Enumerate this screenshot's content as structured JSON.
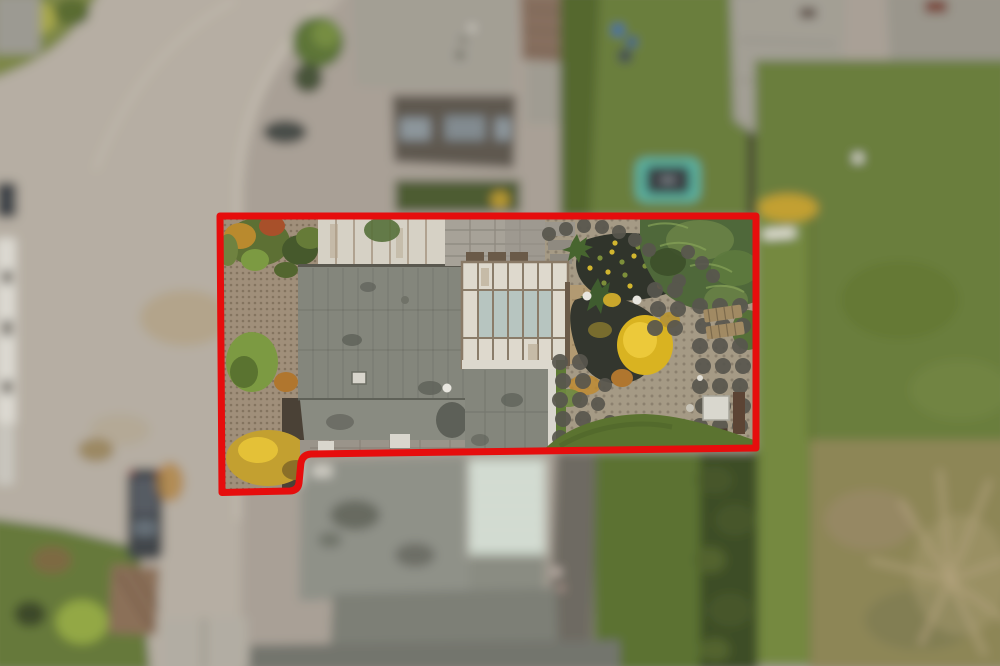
{
  "meta": {
    "image_type": "aerial-drone-photograph",
    "view": "top-down nadir view of suburban residential parcels, autumn",
    "focus": "center parcel sharp, surroundings motion/depth blurred",
    "annotation_kind": "property boundary outline"
  },
  "annotation": {
    "boundary_path": "M220,216 L756,216 L756,448 L311,454 Q302,454.6 300.8,464 L299,483 Q298,490.5 290,491 L222,492.5 Z",
    "color": "#e60d0d",
    "stroke_width": 7
  },
  "palette": {
    "pavement": "#a9a096",
    "road": "#b6aea3",
    "curb": "#cfc8bc",
    "road_leaves": "#b09a6f",
    "roof_main": "#84867c",
    "roof_seam": "#5a584f",
    "roof_panel": "#d6d1c5",
    "panel_seam": "#a3937f",
    "frame_white": "#ded9cd",
    "glass": "#b7c5c0",
    "mullion": "#8a7c69",
    "gravel": "#a08f7a",
    "garden_ground": "#a59a85",
    "paver": "#58564e",
    "slab": "#a7a298",
    "pond": "#30342b",
    "soil": "#4a4136",
    "hedge": "#4f683a",
    "hedge_hi": "#6d8549",
    "hedge_dark": "#3e4d27",
    "lawn": "#6a7e3c",
    "lawn_bright": "#74893f",
    "lawn_in": "#5b7330",
    "meadow": "#8d8657",
    "meadow_tree": "#b4a37d",
    "terrace": "#b29a72",
    "wood": "#a18a63",
    "wood_dark": "#6a5a48",
    "tramp_ring": "#5ab3a1",
    "tramp_mat": "#3a4045",
    "roof_neighbor": "#a39f94",
    "roof_brown": "#87705f",
    "wall_dark": "#5e5850",
    "conservatory": "#c9d4c9",
    "conservatory_line": "#ecefe7",
    "drive": "#6e6b62",
    "shed": "#8b6f58",
    "car_dark": "#42464b",
    "white_detail": "#ded9cf",
    "yellow_shrub": "#c3a030",
    "yellow_tree": "#d9b321",
    "yellow_tree_hi": "#ecc93a",
    "orange_shrub": "#b0762e",
    "bush_green": "#7c9a42",
    "bush_dark": "#46592c",
    "roof_front": "#8f9188",
    "roof_low": "#7d7f76",
    "stain": "#5e6058"
  },
  "garden": {
    "paver_clusters": [
      {
        "type": "points",
        "r": 7,
        "points": [
          [
            549,
            234
          ],
          [
            566,
            229
          ],
          [
            584,
            226
          ],
          [
            602,
            227
          ],
          [
            619,
            232
          ],
          [
            635,
            240
          ],
          [
            649,
            250
          ]
        ]
      },
      {
        "type": "points",
        "r": 7,
        "points": [
          [
            688,
            252
          ],
          [
            702,
            263
          ],
          [
            713,
            276
          ],
          [
            679,
            281
          ]
        ]
      },
      {
        "type": "grid",
        "x": 700,
        "y": 306,
        "dx": 20,
        "dy": 20,
        "cols": 3,
        "rows": 7,
        "r": 8
      },
      {
        "type": "grid",
        "x": 655,
        "y": 290,
        "dx": 20,
        "dy": 19,
        "cols": 2,
        "rows": 3,
        "r": 8
      },
      {
        "type": "grid",
        "x": 560,
        "y": 362,
        "dx": 20,
        "dy": 19,
        "cols": 2,
        "rows": 5,
        "r": 8
      },
      {
        "type": "points",
        "r": 7,
        "points": [
          [
            605,
            385
          ],
          [
            598,
            404
          ],
          [
            610,
            422
          ],
          [
            601,
            440
          ],
          [
            622,
            438
          ],
          [
            641,
            444
          ],
          [
            660,
            430
          ],
          [
            676,
            440
          ]
        ]
      }
    ],
    "lily_pads": [
      [
        600,
        258
      ],
      [
        612,
        252
      ],
      [
        622,
        262
      ],
      [
        634,
        256
      ],
      [
        645,
        266
      ],
      [
        608,
        272
      ],
      [
        625,
        275
      ],
      [
        590,
        268
      ],
      [
        638,
        247
      ],
      [
        615,
        243
      ],
      [
        604,
        283
      ],
      [
        630,
        286
      ]
    ],
    "lily_colors": [
      "#7d8f3a",
      "#d2b62f"
    ],
    "lamp_globes": [
      [
        587,
        296
      ],
      [
        637,
        300
      ],
      [
        447,
        388
      ]
    ],
    "lamp_color": "#e8e6df"
  },
  "scene": {
    "in_focus_parcel": [
      {
        "name": "gravel-driveway",
        "desc": "tan gravel forecourt, left side of parcel"
      },
      {
        "name": "shrub-border",
        "desc": "mixed green/orange autumn shrubs along top-left boundary"
      },
      {
        "name": "panel-roof",
        "desc": "weathered white vertical-plank roof section, top of house"
      },
      {
        "name": "main-roof",
        "desc": "large flat grey roof with plank seams, stains and vent"
      },
      {
        "name": "glass-atrium-roof",
        "desc": "white-framed skylight roof with pale green glass panes"
      },
      {
        "name": "terrace",
        "desc": "tan paved terrace right of atrium"
      },
      {
        "name": "pond",
        "desc": "dark garden pond with lily pads and globe lamps"
      },
      {
        "name": "paver-circles",
        "desc": "round dark stepping pavers across rear garden"
      },
      {
        "name": "conifer-hedge",
        "desc": "large green conifer mass in top-right of garden"
      },
      {
        "name": "yellow-maple",
        "desc": "bright yellow autumn shrub in garden center"
      },
      {
        "name": "sun-loungers",
        "desc": "two wooden loungers on circle pavers"
      },
      {
        "name": "garden-table",
        "desc": "white table and dark wood bench, bottom-right"
      },
      {
        "name": "inner-lawn",
        "desc": "green lawn strip along bottom-right inside boundary"
      },
      {
        "name": "extension-roof",
        "desc": "grey rear-extension roof below atrium"
      }
    ],
    "out_of_focus_surroundings": [
      {
        "name": "road",
        "desc": "curving residential street, left side"
      },
      {
        "name": "parked-car",
        "desc": "dark grey car parked at kerb, bottom-left"
      },
      {
        "name": "garden-shed",
        "desc": "brown shed roof, bottom-left"
      },
      {
        "name": "neighbor-houses-top",
        "desc": "neighbouring roofs along top edge"
      },
      {
        "name": "back-lawn",
        "desc": "subject rear lawn above boundary with teal trampoline"
      },
      {
        "name": "neighbor-house-right",
        "desc": "two grey roofs, top-right"
      },
      {
        "name": "right-lawn",
        "desc": "large green lawn, right side"
      },
      {
        "name": "meadow",
        "desc": "brown rough meadow with bare tree, bottom-right"
      },
      {
        "name": "front-house-roof",
        "desc": "blurred grey front roof of subject house below boundary"
      },
      {
        "name": "conservatory-roof",
        "desc": "pale striped conservatory glass roof below boundary"
      },
      {
        "name": "driveway",
        "desc": "dark side path right of front house"
      },
      {
        "name": "hedge-row",
        "desc": "dark shrub row between gardens, bottom-center"
      }
    ]
  }
}
